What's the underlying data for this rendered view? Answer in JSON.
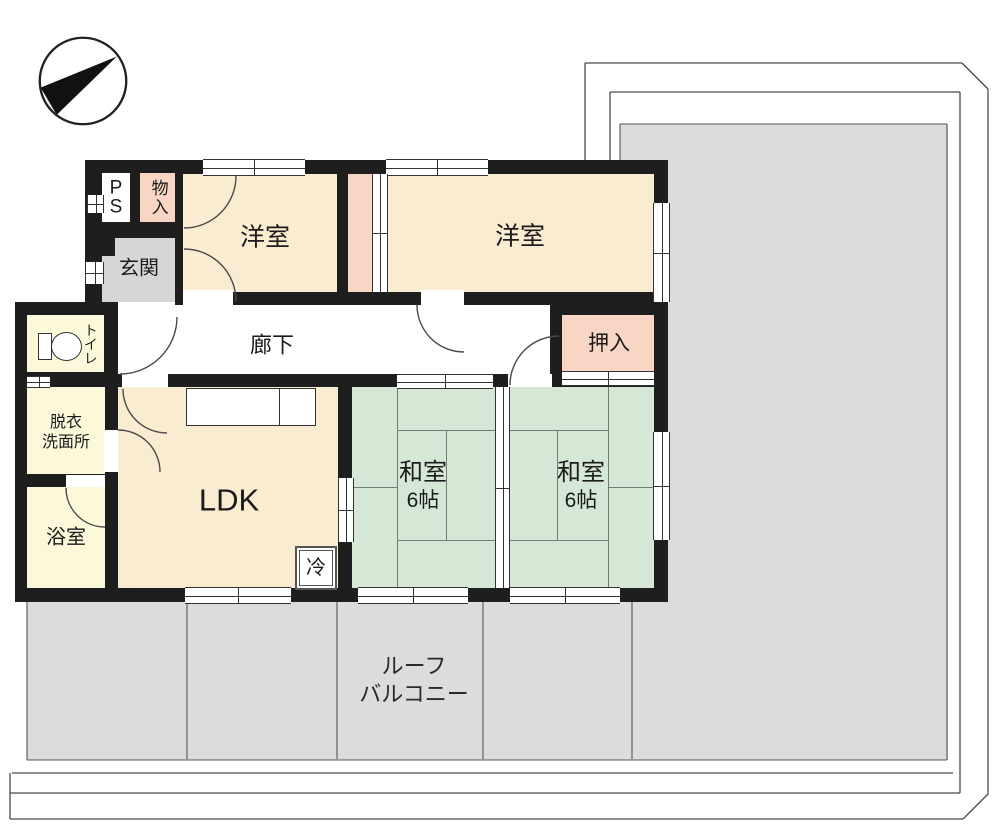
{
  "plan": {
    "title": "apartment floor plan",
    "compass_direction": "NE",
    "rooms": {
      "ps": "PS",
      "storage_top": "物入",
      "genkan": "玄関",
      "western1": "洋室",
      "western2": "洋室",
      "corridor": "廊下",
      "oshiire": "押入",
      "japanese1": {
        "name": "和室",
        "size": "6帖"
      },
      "japanese2": {
        "name": "和室",
        "size": "6帖"
      },
      "ldk": "LDK",
      "fridge": "冷",
      "toilet": "トイレ",
      "dressing": {
        "line1": "脱衣",
        "line2": "洗面所"
      },
      "bath": "浴室",
      "balcony": {
        "line1": "ルーフ",
        "line2": "バルコニー"
      }
    }
  },
  "colors": {
    "wall": "#1e1e1e",
    "room": "#faecd1",
    "closet": "#f8d6c3",
    "tatami": "#d5e8d6",
    "wet": "#fbf9da",
    "genkan": "#d6d6d6",
    "balcony": "#dcdcde",
    "line": "#555555"
  }
}
